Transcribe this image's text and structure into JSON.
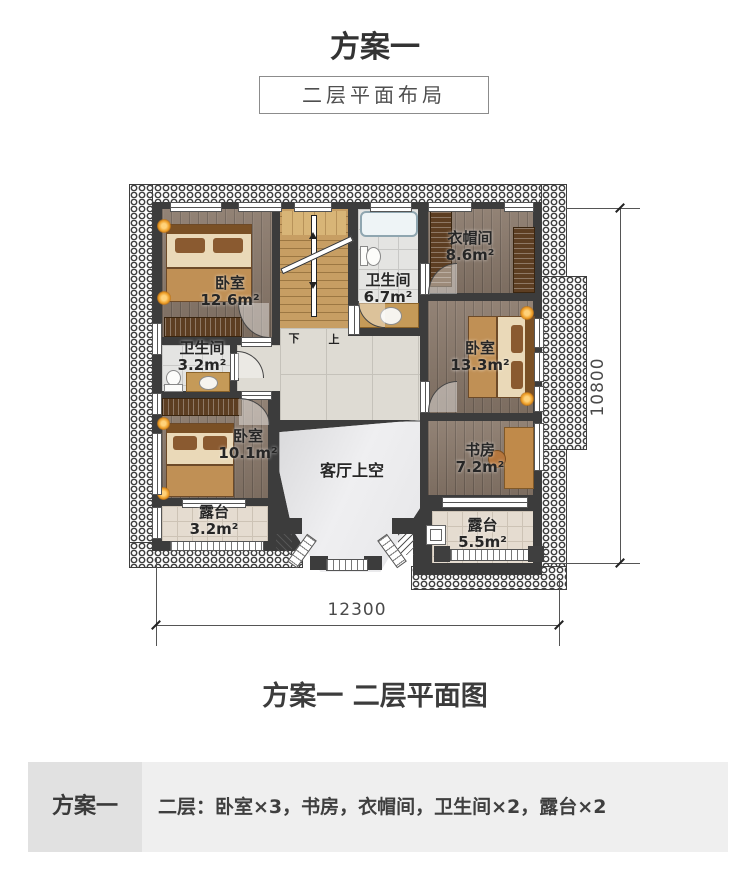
{
  "header": {
    "title": "方案一",
    "subtitle": "二层平面布局"
  },
  "floor_plan": {
    "rooms": [
      {
        "id": "bedroom-126",
        "name": "卧室",
        "area": "12.6m²"
      },
      {
        "id": "bathroom-67",
        "name": "卫生间",
        "area": "6.7m²"
      },
      {
        "id": "cloakroom-86",
        "name": "衣帽间",
        "area": "8.6m²"
      },
      {
        "id": "bedroom-133",
        "name": "卧室",
        "area": "13.3m²"
      },
      {
        "id": "study-72",
        "name": "书房",
        "area": "7.2m²"
      },
      {
        "id": "terrace-55",
        "name": "露台",
        "area": "5.5m²"
      },
      {
        "id": "bathroom-32",
        "name": "卫生间",
        "area": "3.2m²"
      },
      {
        "id": "bedroom-101",
        "name": "卧室",
        "area": "10.1m²"
      },
      {
        "id": "terrace-32",
        "name": "露台",
        "area": "3.2m²"
      },
      {
        "id": "living-void",
        "name": "客厅上空",
        "area": ""
      }
    ],
    "stairs": {
      "down_label": "下",
      "up_label": "上"
    },
    "dimensions": {
      "width_mm": "12300",
      "height_mm": "10800"
    },
    "colors": {
      "wall": "#3c3c3c",
      "wood_floor": "#8a796b",
      "stair_wood": "#c79e63",
      "bath_tile": "#e4e4e2",
      "hall_tile": "#dedbd3",
      "terrace_tile": "#e5dcd0",
      "void_fill": "#e9e9eb",
      "lamp_glow": "#f0a132"
    }
  },
  "caption": {
    "text": "方案一 二层平面图"
  },
  "summary": {
    "plan_label": "方案一",
    "description": "二层：卧室×3，书房，衣帽间，卫生间×2，露台×2"
  }
}
